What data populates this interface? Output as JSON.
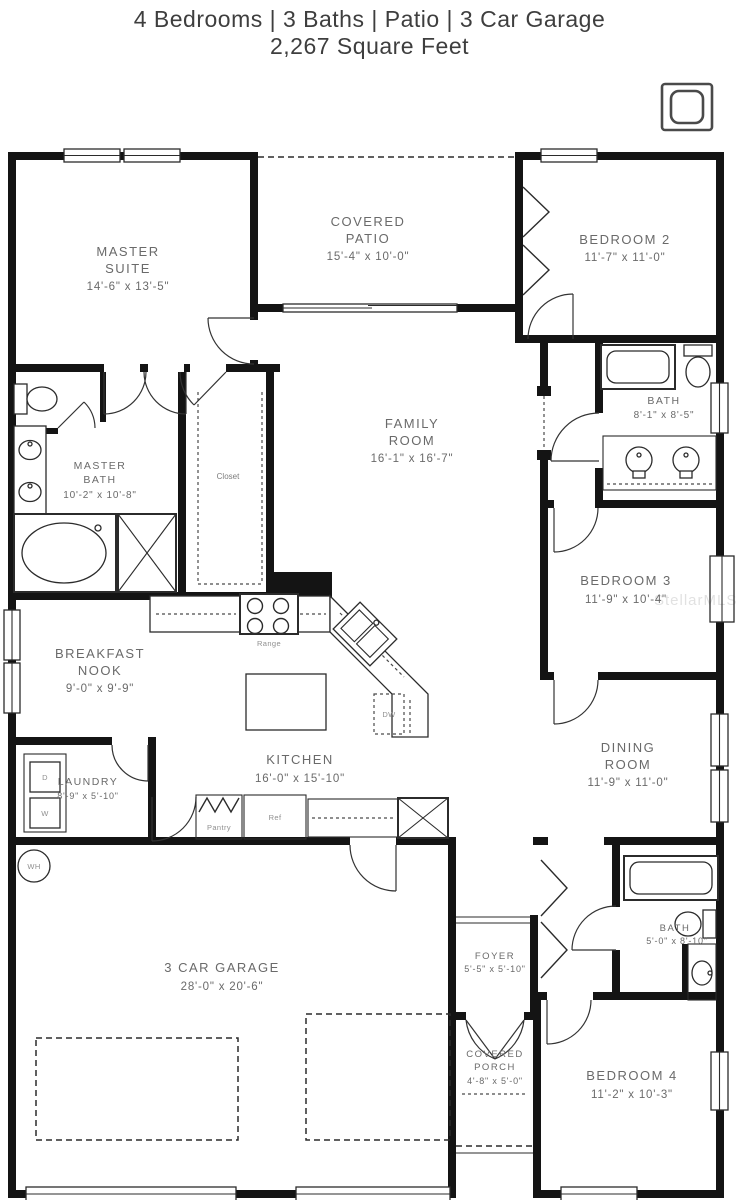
{
  "header": {
    "title": "4 Bedrooms | 3 Baths | Patio | 3 Car Garage",
    "subtitle": "2,267 Square Feet"
  },
  "watermark": "StellarMLS",
  "rooms": {
    "master_suite": {
      "lines": [
        "MASTER",
        "SUITE",
        "14'-6\" x 13'-5\""
      ]
    },
    "covered_patio": {
      "lines": [
        "COVERED",
        "PATIO",
        "15'-4\" x 10'-0\""
      ]
    },
    "bedroom2": {
      "lines": [
        "BEDROOM 2",
        "11'-7\" x 11'-0\""
      ]
    },
    "family_room": {
      "lines": [
        "FAMILY",
        "ROOM",
        "16'-1\" x 16'-7\""
      ]
    },
    "master_bath": {
      "lines": [
        "MASTER",
        "BATH",
        "10'-2\" x 10'-8\""
      ]
    },
    "bath2": {
      "lines": [
        "BATH",
        "8'-1\" x 8'-5\""
      ]
    },
    "bedroom3": {
      "lines": [
        "BEDROOM 3",
        "11'-9\" x 10'-4\""
      ]
    },
    "breakfast_nook": {
      "lines": [
        "BREAKFAST",
        "NOOK",
        "9'-0\" x 9'-9\""
      ]
    },
    "kitchen": {
      "lines": [
        "KITCHEN",
        "16'-0\" x 15'-10\""
      ]
    },
    "dining_room": {
      "lines": [
        "DINING",
        "ROOM",
        "11'-9\" x 11'-0\""
      ]
    },
    "laundry": {
      "lines": [
        "LAUNDRY",
        "8'-9\" x 5'-10\""
      ]
    },
    "garage": {
      "lines": [
        "3 CAR GARAGE",
        "28'-0\" x 20'-6\""
      ]
    },
    "foyer": {
      "lines": [
        "FOYER",
        "5'-5\" x 5'-10\""
      ]
    },
    "bath3": {
      "lines": [
        "BATH",
        "5'-0\" x 8'-10\""
      ]
    },
    "covered_porch": {
      "lines": [
        "COVERED",
        "PORCH",
        "4'-8\" x 5'-0\""
      ]
    },
    "bedroom4": {
      "lines": [
        "BEDROOM 4",
        "11'-2\" x 10'-3\""
      ]
    }
  },
  "fixtures": {
    "closet": "Closet",
    "range": "Range",
    "dishwasher": "DW",
    "refrigerator": "Ref",
    "pantry": "Pantry",
    "dryer": "D",
    "washer": "W",
    "water_heater": "WH"
  },
  "colors": {
    "wall": "#141414",
    "label": "#6a6a6a",
    "background": "#ffffff"
  }
}
